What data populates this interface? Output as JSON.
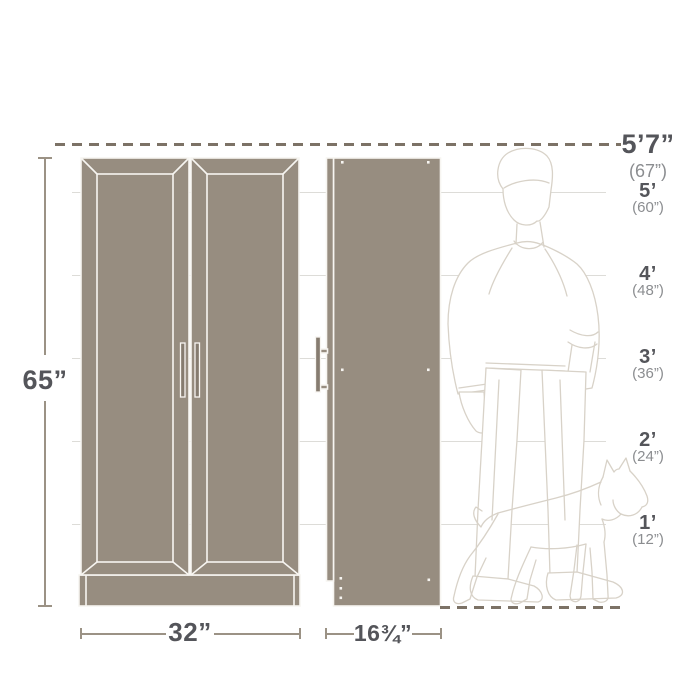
{
  "diagram": {
    "product": {
      "height": "65”",
      "width": "32”",
      "depth": "16¾”"
    },
    "reference": {
      "person_height": "5’7”",
      "person_height_inches": "(67”)",
      "markers": [
        {
          "feet": "5’",
          "inches": "(60”)"
        },
        {
          "feet": "4’",
          "inches": "(48”)"
        },
        {
          "feet": "3’",
          "inches": "(36”)"
        },
        {
          "feet": "2’",
          "inches": "(24”)"
        },
        {
          "feet": "1’",
          "inches": "(12”)"
        }
      ]
    },
    "colors": {
      "cabinet_fill": "#978d80",
      "cabinet_line": "#f7f5f1",
      "dimension_line": "#9b9285",
      "dash_line": "#7c7266",
      "text_primary": "#54555a",
      "text_secondary": "#8b8d90",
      "grid_line": "#dddcd8",
      "figure_line": "#d8d2c8"
    }
  }
}
